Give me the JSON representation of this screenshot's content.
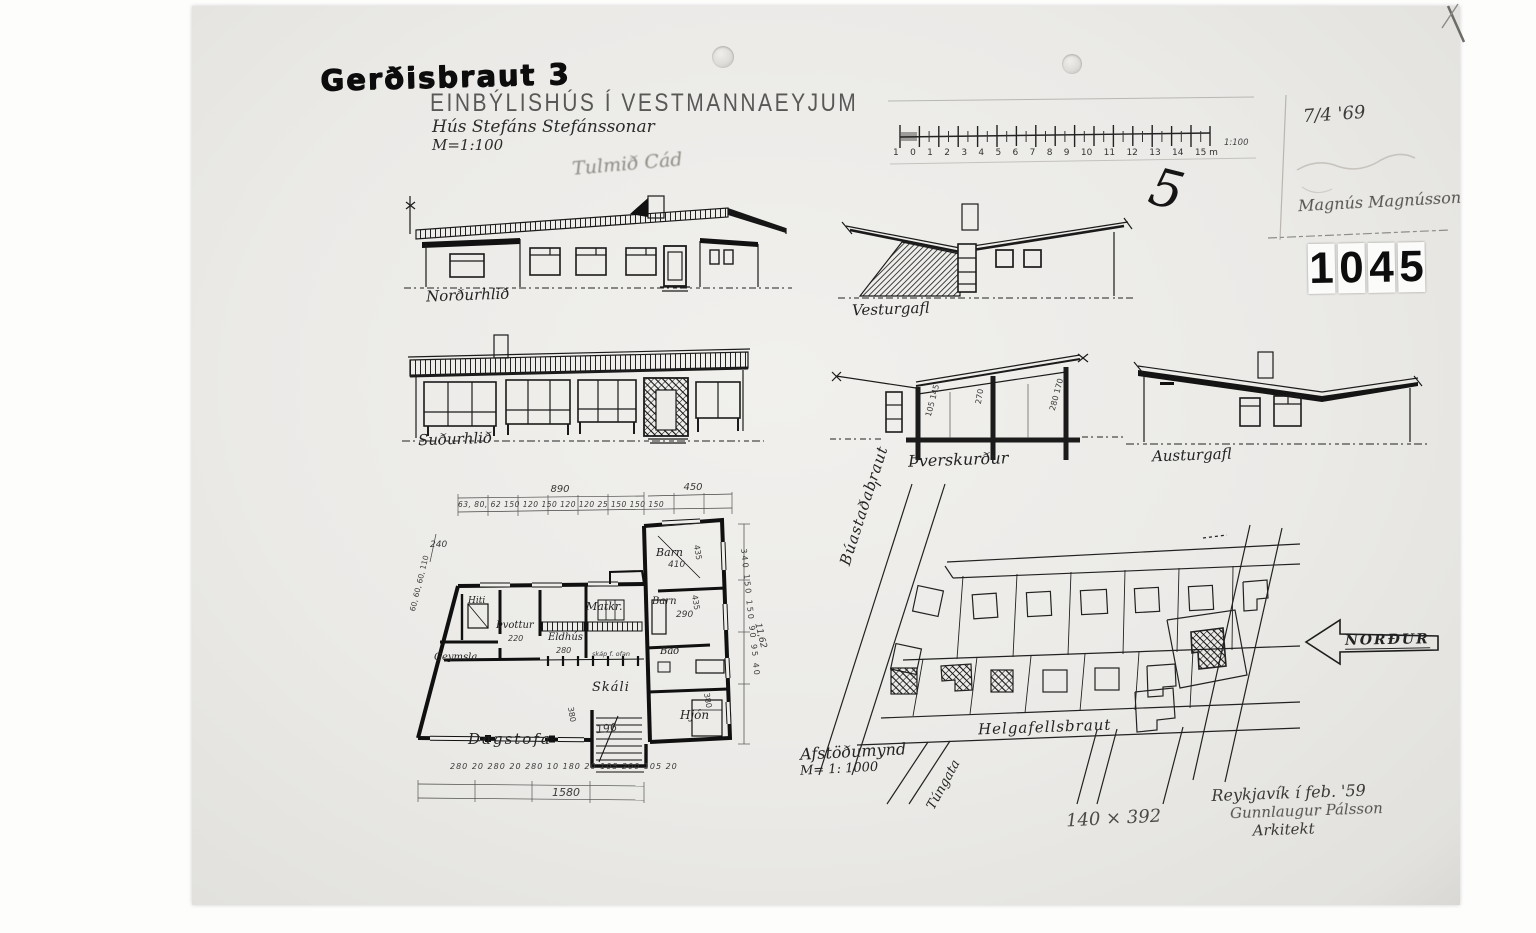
{
  "sheet": {
    "address": "Gerðisbraut 3",
    "title": "EINBÝLISHÚS Í VESTMANNAEYJUM",
    "subtitle": "Hús Stefáns Stefánssonar",
    "scale": "M=1:100",
    "faint_note": "Tulmið Cád",
    "date_note": "7/4 '69",
    "signature": "Magnús Magnússon",
    "stamp_digits": [
      "1",
      "0",
      "4",
      "5"
    ],
    "check_mark": "5"
  },
  "scale_bar": {
    "ticks": [
      "1",
      "0",
      "1",
      "2",
      "3",
      "4",
      "5",
      "6",
      "7",
      "8",
      "9",
      "10",
      "11",
      "12",
      "13",
      "14",
      "15 m"
    ],
    "ratio": "1:100"
  },
  "elevations": {
    "north": {
      "label": "Norðurhlið"
    },
    "south": {
      "label": "Suðurhlið"
    },
    "west": {
      "label": "Vesturgafl"
    },
    "section": {
      "label": "Þverskurður",
      "dims_left": "105 145",
      "dims_mid": "270",
      "dims_right": "280 170"
    },
    "east": {
      "label": "Austurgafl"
    }
  },
  "floor_plan": {
    "dim_top_left": "890",
    "dim_top_right": "450",
    "dim_top_sub": "63, 80, 62  150  120  150  120  120  25  150  150  150",
    "dim_left": "240",
    "dim_left_diag": "60, 60, 60, 110",
    "dim_bottom_sub": "280  20  280  20  280  10  180  20  105  200  105  20",
    "dim_bottom_total": "1580",
    "dim_right_sub": "340   150   150   90 95 40",
    "dim_right_total": "11,62",
    "rooms": {
      "hiti": "Hiti",
      "thvottur": "Þvottur",
      "thvottur_dim": "220",
      "geymsla": "Geymsla",
      "eldhus": "Eldhús",
      "eldhus_dim": "280",
      "matkr": "Matkr.",
      "matkr_note": "skáp f. ofan",
      "skali": "Skáli",
      "dagstofa": "Dagstofa",
      "stairs_dim": "196",
      "barn1": "Barn",
      "barn1_dim": "410",
      "barn2": "Barn",
      "barn2_dim": "290",
      "barn_height_dim": "435",
      "bad": "Bað",
      "hjon": "Hjón",
      "hjon_dim": "380"
    }
  },
  "site_plan": {
    "streets": {
      "buastadabraut": "Búastaðabraut",
      "helgafellsbraut": "Helgafellsbraut",
      "tungata": "Túngata"
    },
    "north_arrow": "NORÐUR",
    "caption": "Afstöðumynd",
    "caption_scale": "M= 1: 1000"
  },
  "footer": {
    "size_note": "140 × 392",
    "place_date": "Reykjavík í feb. '59",
    "signature": "Gunnlaugur Pálsson",
    "role": "Arkitekt"
  }
}
